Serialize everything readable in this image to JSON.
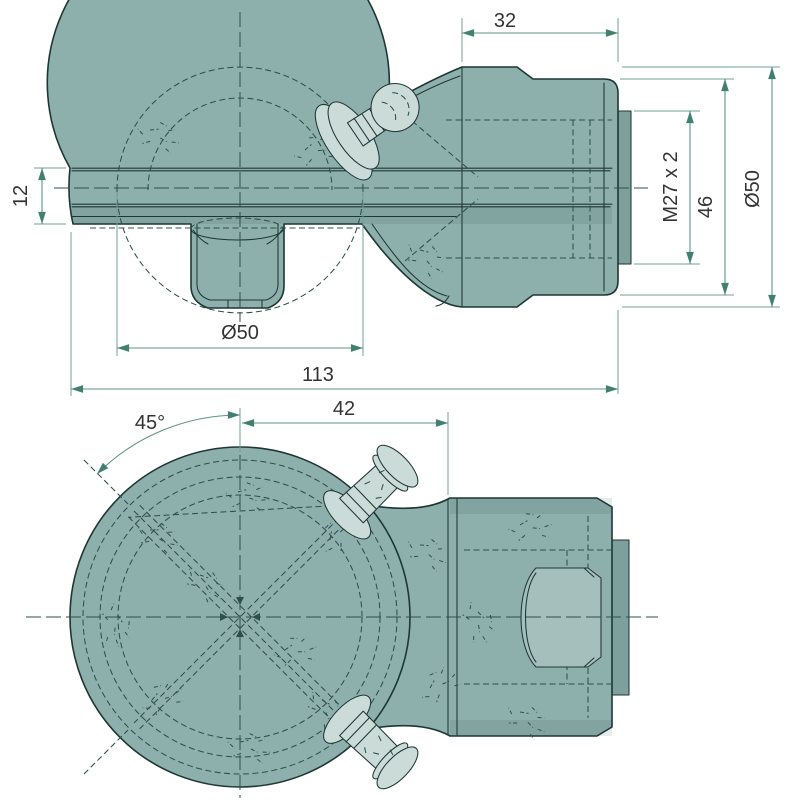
{
  "drawing": {
    "dimensions": {
      "shaft_section_length": "32",
      "coupling_slot_height": "12",
      "thread_spec": "M27 x 2",
      "hex_across_flats": "46",
      "shaft_diameter": "Ø50",
      "ball_diameter": "Ø50",
      "overall_length": "113",
      "ball_center_to_shaft": "42",
      "grease_nipple_angle": "45°"
    },
    "colors": {
      "background": "#FFFFFF",
      "part_fill": "#8EB0AC",
      "part_fill_light": "#CBDCD8",
      "part_fill_dark": "#7EA09C",
      "outline": "#1E3634",
      "hidden_line": "#2F4F4A",
      "dimension_line": "#5E948A",
      "dimension_arrow": "#41806F",
      "dimension_text": "#333333"
    }
  }
}
